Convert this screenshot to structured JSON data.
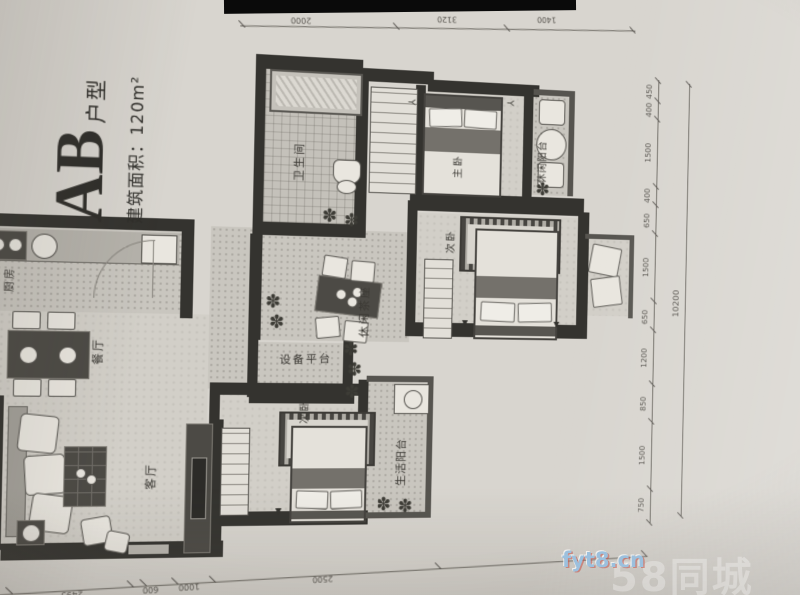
{
  "title": {
    "main": "AB",
    "suffix": "户型",
    "area": "建筑面积：120m²"
  },
  "rooms": {
    "bathroom": "卫生间",
    "master_bedroom": "主卧",
    "leisure_balcony": "休闲阳台",
    "bedroom2": "次卧",
    "leisure_seating": "休闲茶座",
    "equipment_platform": "设备平台",
    "bedroom3": "次卧",
    "life_balcony": "生活阳台",
    "kitchen": "厨房",
    "dining": "餐厅",
    "living": "客厅"
  },
  "dimensions": {
    "top": [
      "2000",
      "3120",
      "1400"
    ],
    "right": [
      "450",
      "400",
      "1500",
      "400",
      "650",
      "1500",
      "650",
      "1200",
      "850",
      "1500",
      "750"
    ],
    "right_total": "10200",
    "bottom": [
      "1495",
      "2495",
      "600",
      "1000",
      "2500"
    ]
  },
  "watermark": {
    "site": "fyt8.cn",
    "faint": "58同城"
  },
  "icons": {
    "plant": "✽",
    "hanger": "Y",
    "door_mark": "▲"
  },
  "colors": {
    "paper": "#d8d5cf",
    "wall": "#34332f",
    "watermark_blue": "#9cc0dd"
  }
}
